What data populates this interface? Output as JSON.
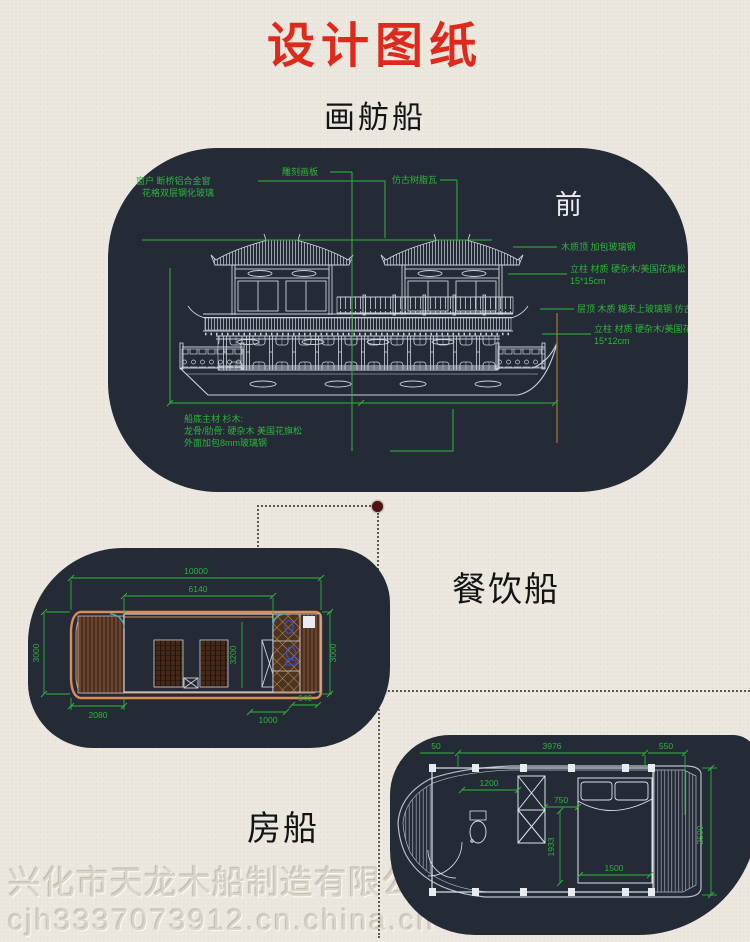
{
  "page": {
    "title": "设计图纸",
    "subtitle": "画舫船",
    "watermark": {
      "line1": "兴化市天龙木船制造有限公司",
      "line2": "cjh3337073912.cn.china.cn"
    },
    "colors": {
      "title_red": "#df291d",
      "panel_navy": "#242a36",
      "cad_green": "#2fb53c",
      "cad_white": "#cdd2da",
      "hull_orange": "#d98e57",
      "fixture_blue": "#2f50e0",
      "door_cyan": "#28c2d3",
      "connector_dot_maroon": "#4e1310",
      "paper": "#eae6de"
    }
  },
  "elevation": {
    "direction_label": "前",
    "labels": {
      "window_line1": "窗户 断桥铝合金窗",
      "window_line2": "花格双层钢化玻璃",
      "carved_panel": "雕刻画板",
      "antique_tile": "仿古树脂瓦",
      "wood_top": "木质顶 加包玻璃钢",
      "pillar_upper_line1": "立柱 材质 硬杂木/美国花旗松",
      "pillar_upper_line2": "15*15cm",
      "roof_layer": "层顶 木质 糊来上玻璃钢 仿古轩",
      "pillar_lower_line1": "立柱 材质 硬杂木/美国花旗",
      "pillar_lower_line2": "15*12cm",
      "hull_line1": "船底主材 杉木:",
      "hull_line2": "龙骨/肋骨: 硬杂木 美国花旗松",
      "hull_line3": "外面加包8mm玻璃钢"
    }
  },
  "dining_boat": {
    "label": "餐饮船",
    "dims": {
      "overall": "10000",
      "cabin": "6140",
      "beam_left": "3000",
      "cabin_width": "3200",
      "beam_right": "3000",
      "bow_deck": "2080",
      "wc": "1000",
      "stern": "640"
    }
  },
  "house_boat": {
    "label": "房船",
    "dims": {
      "cabin": "3976",
      "stern_deck": "550",
      "bow_partial": "50",
      "wc_room": "1200",
      "aisle": "750",
      "inner_width": "1933",
      "bed": "1500",
      "beam": "2500"
    }
  }
}
